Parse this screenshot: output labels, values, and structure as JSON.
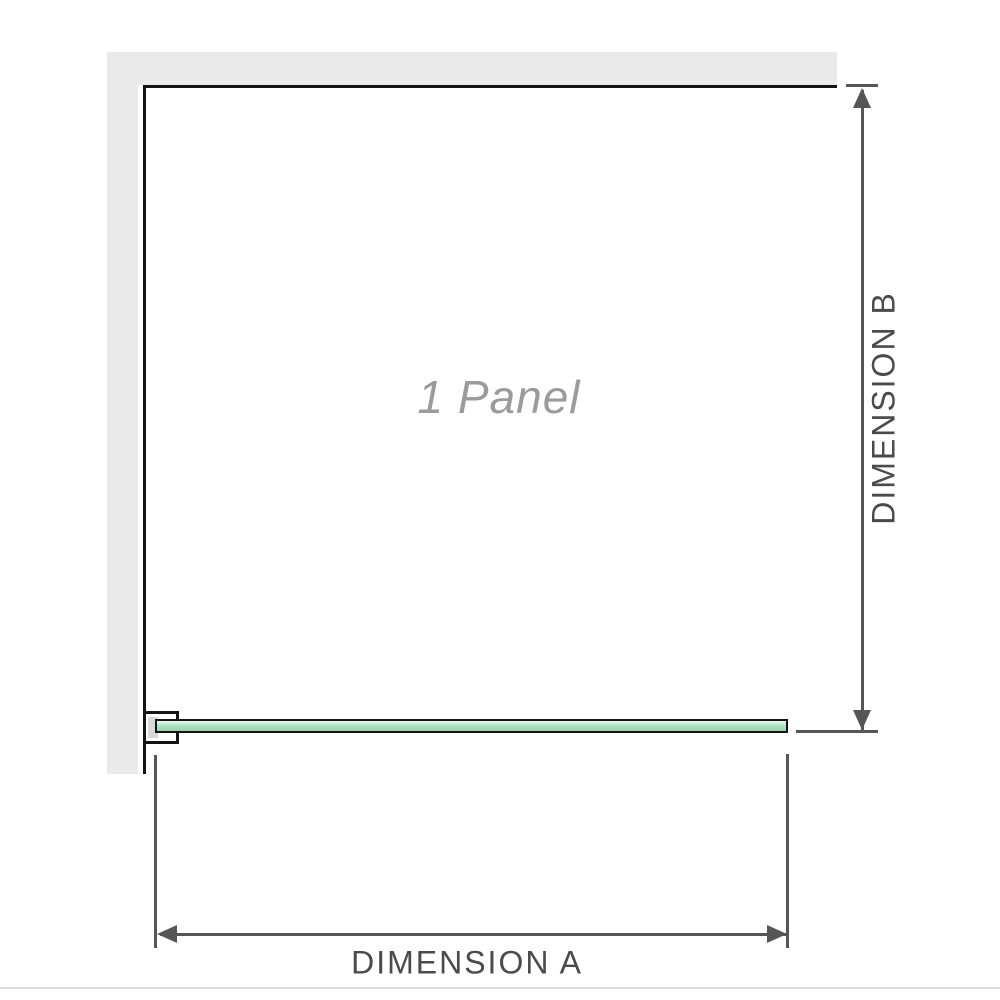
{
  "diagram": {
    "panel_label": "1 Panel",
    "dimensions": {
      "a_label": "DIMENSION A",
      "b_label": "DIMENSION B"
    }
  },
  "theme": {
    "bg": "#ffffff",
    "wall": "#eaeaea",
    "outline": "#141414",
    "clamp-insert": "#d9d9d9",
    "glass-top": "#eef9f2",
    "glass-mid": "#b7e5ca",
    "glass-bottom": "#97d0ad",
    "dim": "#565656",
    "label": "#4b4b4b",
    "panel-text": "#9b9b9b",
    "page-edge": "#d9ded9"
  }
}
